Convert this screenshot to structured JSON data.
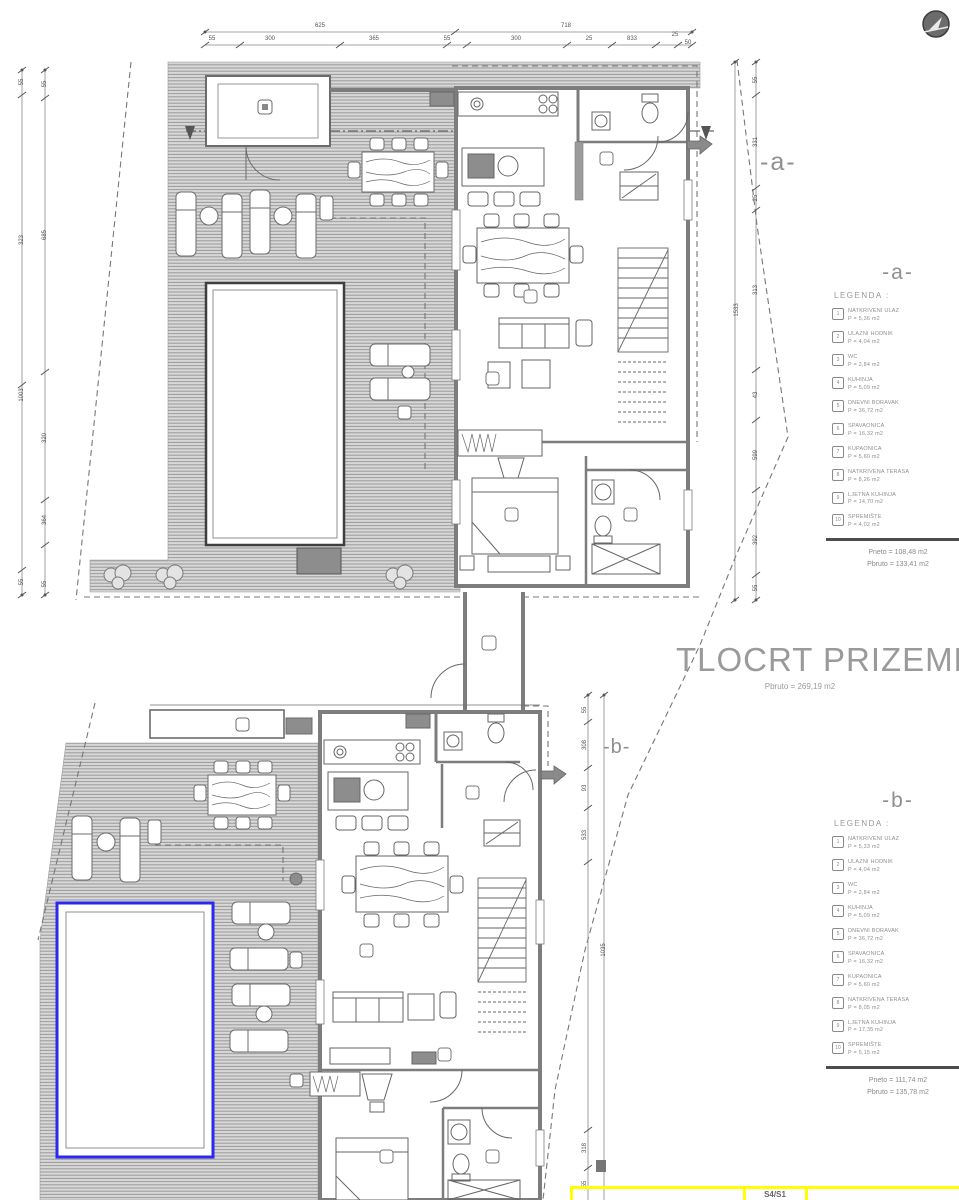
{
  "accent": {
    "pool_b_border": "#2a2aee",
    "table_border": "#ffff00",
    "ink": "#555555",
    "label_gray": "#9a9a9a"
  },
  "title": {
    "text": "TLOCRT PRIZEMLJA",
    "subtitle": "Pbruto = 269,19 m2"
  },
  "section_markers": {
    "a": "-a-",
    "b": "-b-"
  },
  "legend_a": {
    "marker": "-a-",
    "heading": "LEGENDA :",
    "items": [
      {
        "num": "1",
        "name": "NATKRIVENI ULAZ",
        "area": "P = 5,36 m2"
      },
      {
        "num": "2",
        "name": "ULAZNI HODNIK",
        "area": "P = 4,04 m2"
      },
      {
        "num": "3",
        "name": "WC",
        "area": "P = 2,84 m2"
      },
      {
        "num": "4",
        "name": "KUHINJA",
        "area": "P = 5,09 m2"
      },
      {
        "num": "5",
        "name": "DNEVNI BORAVAK",
        "area": "P = 36,72 m2"
      },
      {
        "num": "6",
        "name": "SPAVAONICA",
        "area": "P = 16,32 m2"
      },
      {
        "num": "7",
        "name": "KUPAONICA",
        "area": "P = 5,60 m2"
      },
      {
        "num": "8",
        "name": "NATKRIVENA TERASA",
        "area": "P = 8,26 m2"
      },
      {
        "num": "9",
        "name": "LJETNA KUHINJA",
        "area": "P = 14,70 m2"
      },
      {
        "num": "10",
        "name": "SPREMIŠTE",
        "area": "P = 4,02 m2"
      }
    ],
    "neto": "Pneto = 108,48 m2",
    "bruto": "Pbruto = 133,41 m2"
  },
  "legend_b": {
    "marker": "-b-",
    "heading": "LEGENDA :",
    "items": [
      {
        "num": "1",
        "name": "NATKRIVENI ULAZ",
        "area": "P = 5,33 m2"
      },
      {
        "num": "2",
        "name": "ULAZNI HODNIK",
        "area": "P = 4,04 m2"
      },
      {
        "num": "3",
        "name": "WC",
        "area": "P = 2,84 m2"
      },
      {
        "num": "4",
        "name": "KUHINJA",
        "area": "P = 5,09 m2"
      },
      {
        "num": "5",
        "name": "DNEVNI BORAVAK",
        "area": "P = 36,72 m2"
      },
      {
        "num": "6",
        "name": "SPAVAONICA",
        "area": "P = 16,32 m2"
      },
      {
        "num": "7",
        "name": "KUPAONICA",
        "area": "P = 5,60 m2"
      },
      {
        "num": "8",
        "name": "NATKRIVENA TERASA",
        "area": "P = 8,05 m2"
      },
      {
        "num": "9",
        "name": "LJETNA KUHINJA",
        "area": "P = 17,35 m2"
      },
      {
        "num": "10",
        "name": "SPREMIŠTE",
        "area": "P = 5,15 m2"
      }
    ],
    "neto": "Pneto = 111,74 m2",
    "bruto": "Pbruto = 135,78 m2"
  },
  "bottom_table": {
    "cell_label": "S4/S1"
  },
  "dimensions": {
    "labels": [
      {
        "t": "625",
        "x": 320,
        "y": 26
      },
      {
        "t": "718",
        "x": 566,
        "y": 26
      },
      {
        "t": "55",
        "x": 212,
        "y": 39
      },
      {
        "t": "300",
        "x": 270,
        "y": 39
      },
      {
        "t": "365",
        "x": 374,
        "y": 39
      },
      {
        "t": "55",
        "x": 447,
        "y": 39
      },
      {
        "t": "300",
        "x": 516,
        "y": 39
      },
      {
        "t": "25",
        "x": 589,
        "y": 39
      },
      {
        "t": "833",
        "x": 632,
        "y": 39
      },
      {
        "t": "25",
        "x": 675,
        "y": 35
      },
      {
        "t": "50",
        "x": 688,
        "y": 43
      },
      {
        "t": "55",
        "x": 22,
        "y": 82,
        "r": -90
      },
      {
        "t": "323",
        "x": 22,
        "y": 240,
        "r": -90
      },
      {
        "t": "1003",
        "x": 22,
        "y": 395,
        "r": -90
      },
      {
        "t": "55",
        "x": 22,
        "y": 582,
        "r": -90
      },
      {
        "t": "55",
        "x": 45,
        "y": 84,
        "r": -90
      },
      {
        "t": "685",
        "x": 45,
        "y": 235,
        "r": -90
      },
      {
        "t": "320",
        "x": 45,
        "y": 438,
        "r": -90
      },
      {
        "t": "364",
        "x": 45,
        "y": 520,
        "r": -90
      },
      {
        "t": "55",
        "x": 45,
        "y": 584,
        "r": -90
      },
      {
        "t": "55",
        "x": 756,
        "y": 80,
        "r": -90
      },
      {
        "t": "331",
        "x": 756,
        "y": 142,
        "r": -90
      },
      {
        "t": "25",
        "x": 756,
        "y": 198,
        "r": -90
      },
      {
        "t": "313",
        "x": 756,
        "y": 290,
        "r": -90
      },
      {
        "t": "43",
        "x": 756,
        "y": 395,
        "r": -90
      },
      {
        "t": "599",
        "x": 756,
        "y": 455,
        "r": -90
      },
      {
        "t": "392",
        "x": 756,
        "y": 540,
        "r": -90
      },
      {
        "t": "55",
        "x": 756,
        "y": 588,
        "r": -90
      },
      {
        "t": "1533",
        "x": 737,
        "y": 310,
        "r": -90
      },
      {
        "t": "55",
        "x": 585,
        "y": 710,
        "r": -90
      },
      {
        "t": "308",
        "x": 585,
        "y": 745,
        "r": -90
      },
      {
        "t": "93",
        "x": 585,
        "y": 788,
        "r": -90
      },
      {
        "t": "533",
        "x": 585,
        "y": 835,
        "r": -90
      },
      {
        "t": "1035",
        "x": 604,
        "y": 950,
        "r": -90
      },
      {
        "t": "318",
        "x": 585,
        "y": 1148,
        "r": -90
      },
      {
        "t": "55",
        "x": 585,
        "y": 1184,
        "r": -90
      }
    ]
  }
}
